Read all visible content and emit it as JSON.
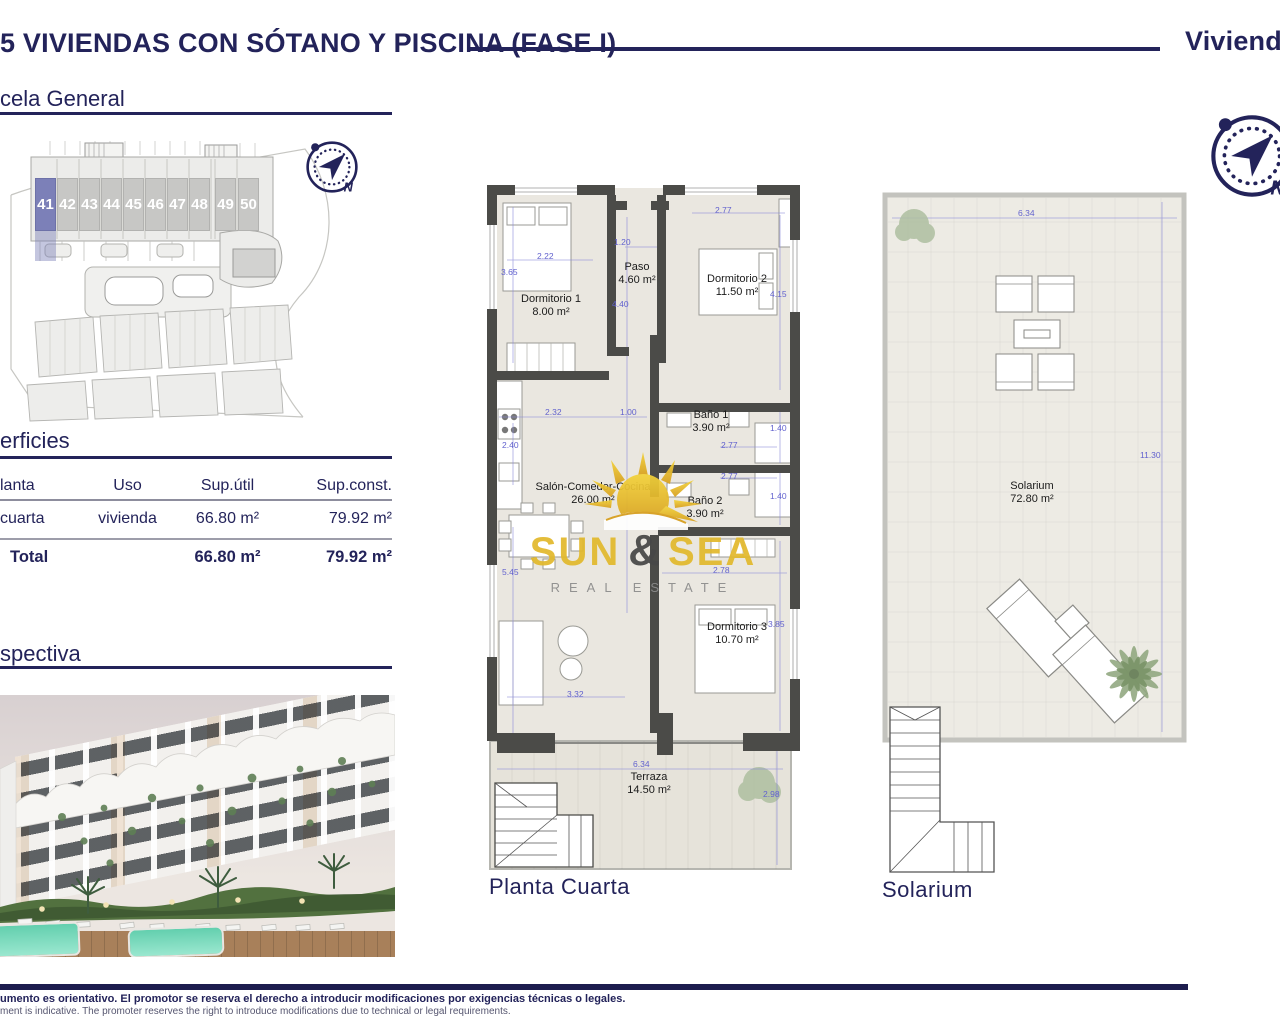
{
  "header": {
    "title": "5 VIVIENDAS CON SÓTANO Y PISCINA (FASE I)",
    "right_label": "Viviendas"
  },
  "sections": {
    "parcela_heading": "cela General",
    "superficies_heading": "erficies",
    "perspectiva_heading": "spectiva"
  },
  "site_plan": {
    "units": [
      "41",
      "42",
      "43",
      "44",
      "45",
      "46",
      "47",
      "48",
      "49",
      "50"
    ],
    "highlighted_unit": "41"
  },
  "compass": {
    "north_label": "N"
  },
  "table": {
    "columns": [
      "lanta",
      "Uso",
      "Sup.útil",
      "Sup.const."
    ],
    "rows": [
      {
        "planta": "cuarta",
        "uso": "vivienda",
        "sup_util": "66.80 m²",
        "sup_const": "79.92 m²"
      }
    ],
    "total": {
      "label": "Total",
      "sup_util": "66.80 m²",
      "sup_const": "79.92 m²"
    }
  },
  "floorplan": {
    "caption": "Planta Cuarta",
    "rooms": [
      {
        "name": "Dormitorio 1",
        "area": "8.00 m²"
      },
      {
        "name": "Paso",
        "area": "4.60 m²"
      },
      {
        "name": "Dormitorio 2",
        "area": "11.50 m²"
      },
      {
        "name": "Baño 1",
        "area": "3.90 m²"
      },
      {
        "name": "Baño 2",
        "area": "3.90 m²"
      },
      {
        "name": "Salón-Comedor-Cocina",
        "area": "26.00 m²"
      },
      {
        "name": "Dormitorio 3",
        "area": "10.70 m²"
      },
      {
        "name": "Terraza",
        "area": "14.50 m²"
      }
    ],
    "dimensions": [
      "3.65",
      "2.22",
      "1.20",
      "4.40",
      "2.77",
      "4.15",
      "2.32",
      "1.00",
      "2.40",
      "1.40",
      "2.77",
      "2.77",
      "1.40",
      "5.45",
      "2.78",
      "3.85",
      "3.32",
      "6.34",
      "2.98"
    ]
  },
  "solarium": {
    "caption": "Solarium",
    "room": {
      "name": "Solarium",
      "area": "72.80 m²"
    },
    "dimensions": [
      "6.34",
      "11.30"
    ]
  },
  "logo": {
    "word1": "SUN",
    "amp": "&",
    "word2": "SEA",
    "subtitle": "REAL ESTATE"
  },
  "footer": {
    "line_es": "umento es orientativo. El promotor se reserva el derecho a introducir modificaciones por exigencias técnicas o legales.",
    "line_en": "ment is indicative. The promoter reserves the right to introduce modifications due to technical or legal requirements."
  },
  "colors": {
    "navy": "#23235a",
    "dimension_blue": "#6262ce",
    "wall_gray": "#4b4b48",
    "highlight_unit": "#7c80b8",
    "logo_yellow": "#e2b92d",
    "logo_gray": "#8c8c8c"
  }
}
